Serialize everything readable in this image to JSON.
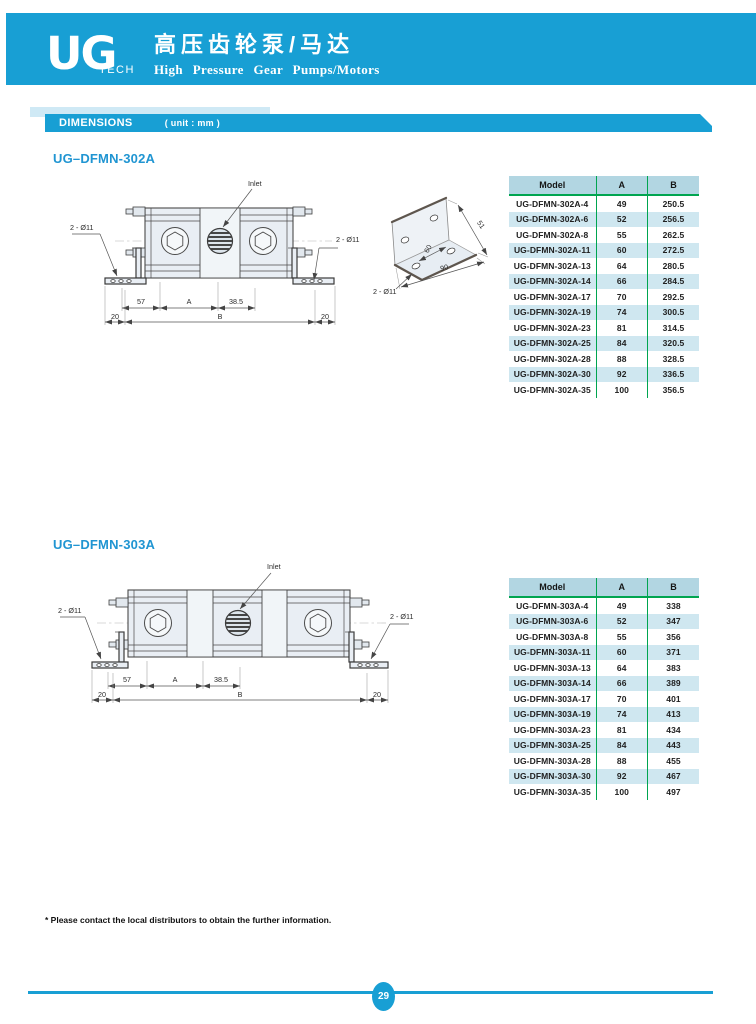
{
  "colors": {
    "brand": "#189fd4",
    "title_blue": "#2095d2",
    "accent_light": "#cfe9f5",
    "green": "#00a550",
    "table_header_bg": "#b2d6e2",
    "row_stripe": "#cfe7f0"
  },
  "header": {
    "logo": "UG",
    "logo_sub": "TECH",
    "title_cn": "高压齿轮泵/马达",
    "title_en": "High Pressure Gear Pumps/Motors"
  },
  "dimensions_bar": {
    "label": "DIMENSIONS",
    "unit": "( unit : mm )"
  },
  "sections": [
    {
      "title": "UG–DFMN-302A",
      "drawing": {
        "inlet": "Inlet",
        "holes_left": "2 - Ø11",
        "holes_right": "2 - Ø11",
        "dim_57": "57",
        "dim_A": "A",
        "dim_385": "38.5",
        "dim_20_left": "20",
        "dim_B": "B",
        "dim_20_right": "20",
        "bracket": {
          "holes": "2 - Ø11",
          "dim_depth": "60",
          "dim_height": "51",
          "dim_width": "90"
        }
      },
      "table": {
        "headers": [
          "Model",
          "A",
          "B"
        ],
        "rows": [
          [
            "UG-DFMN-302A-4",
            "49",
            "250.5"
          ],
          [
            "UG-DFMN-302A-6",
            "52",
            "256.5"
          ],
          [
            "UG-DFMN-302A-8",
            "55",
            "262.5"
          ],
          [
            "UG-DFMN-302A-11",
            "60",
            "272.5"
          ],
          [
            "UG-DFMN-302A-13",
            "64",
            "280.5"
          ],
          [
            "UG-DFMN-302A-14",
            "66",
            "284.5"
          ],
          [
            "UG-DFMN-302A-17",
            "70",
            "292.5"
          ],
          [
            "UG-DFMN-302A-19",
            "74",
            "300.5"
          ],
          [
            "UG-DFMN-302A-23",
            "81",
            "314.5"
          ],
          [
            "UG-DFMN-302A-25",
            "84",
            "320.5"
          ],
          [
            "UG-DFMN-302A-28",
            "88",
            "328.5"
          ],
          [
            "UG-DFMN-302A-30",
            "92",
            "336.5"
          ],
          [
            "UG-DFMN-302A-35",
            "100",
            "356.5"
          ]
        ]
      }
    },
    {
      "title": "UG–DFMN-303A",
      "drawing": {
        "inlet": "Inlet",
        "holes_left": "2 - Ø11",
        "holes_right": "2 - Ø11",
        "dim_57": "57",
        "dim_A": "A",
        "dim_385": "38.5",
        "dim_20_left": "20",
        "dim_B": "B",
        "dim_20_right": "20"
      },
      "table": {
        "headers": [
          "Model",
          "A",
          "B"
        ],
        "rows": [
          [
            "UG-DFMN-303A-4",
            "49",
            "338"
          ],
          [
            "UG-DFMN-303A-6",
            "52",
            "347"
          ],
          [
            "UG-DFMN-303A-8",
            "55",
            "356"
          ],
          [
            "UG-DFMN-303A-11",
            "60",
            "371"
          ],
          [
            "UG-DFMN-303A-13",
            "64",
            "383"
          ],
          [
            "UG-DFMN-303A-14",
            "66",
            "389"
          ],
          [
            "UG-DFMN-303A-17",
            "70",
            "401"
          ],
          [
            "UG-DFMN-303A-19",
            "74",
            "413"
          ],
          [
            "UG-DFMN-303A-23",
            "81",
            "434"
          ],
          [
            "UG-DFMN-303A-25",
            "84",
            "443"
          ],
          [
            "UG-DFMN-303A-28",
            "88",
            "455"
          ],
          [
            "UG-DFMN-303A-30",
            "92",
            "467"
          ],
          [
            "UG-DFMN-303A-35",
            "100",
            "497"
          ]
        ]
      }
    }
  ],
  "footer": {
    "note": "* Please contact the local distributors to obtain the further information.",
    "page": "29"
  }
}
